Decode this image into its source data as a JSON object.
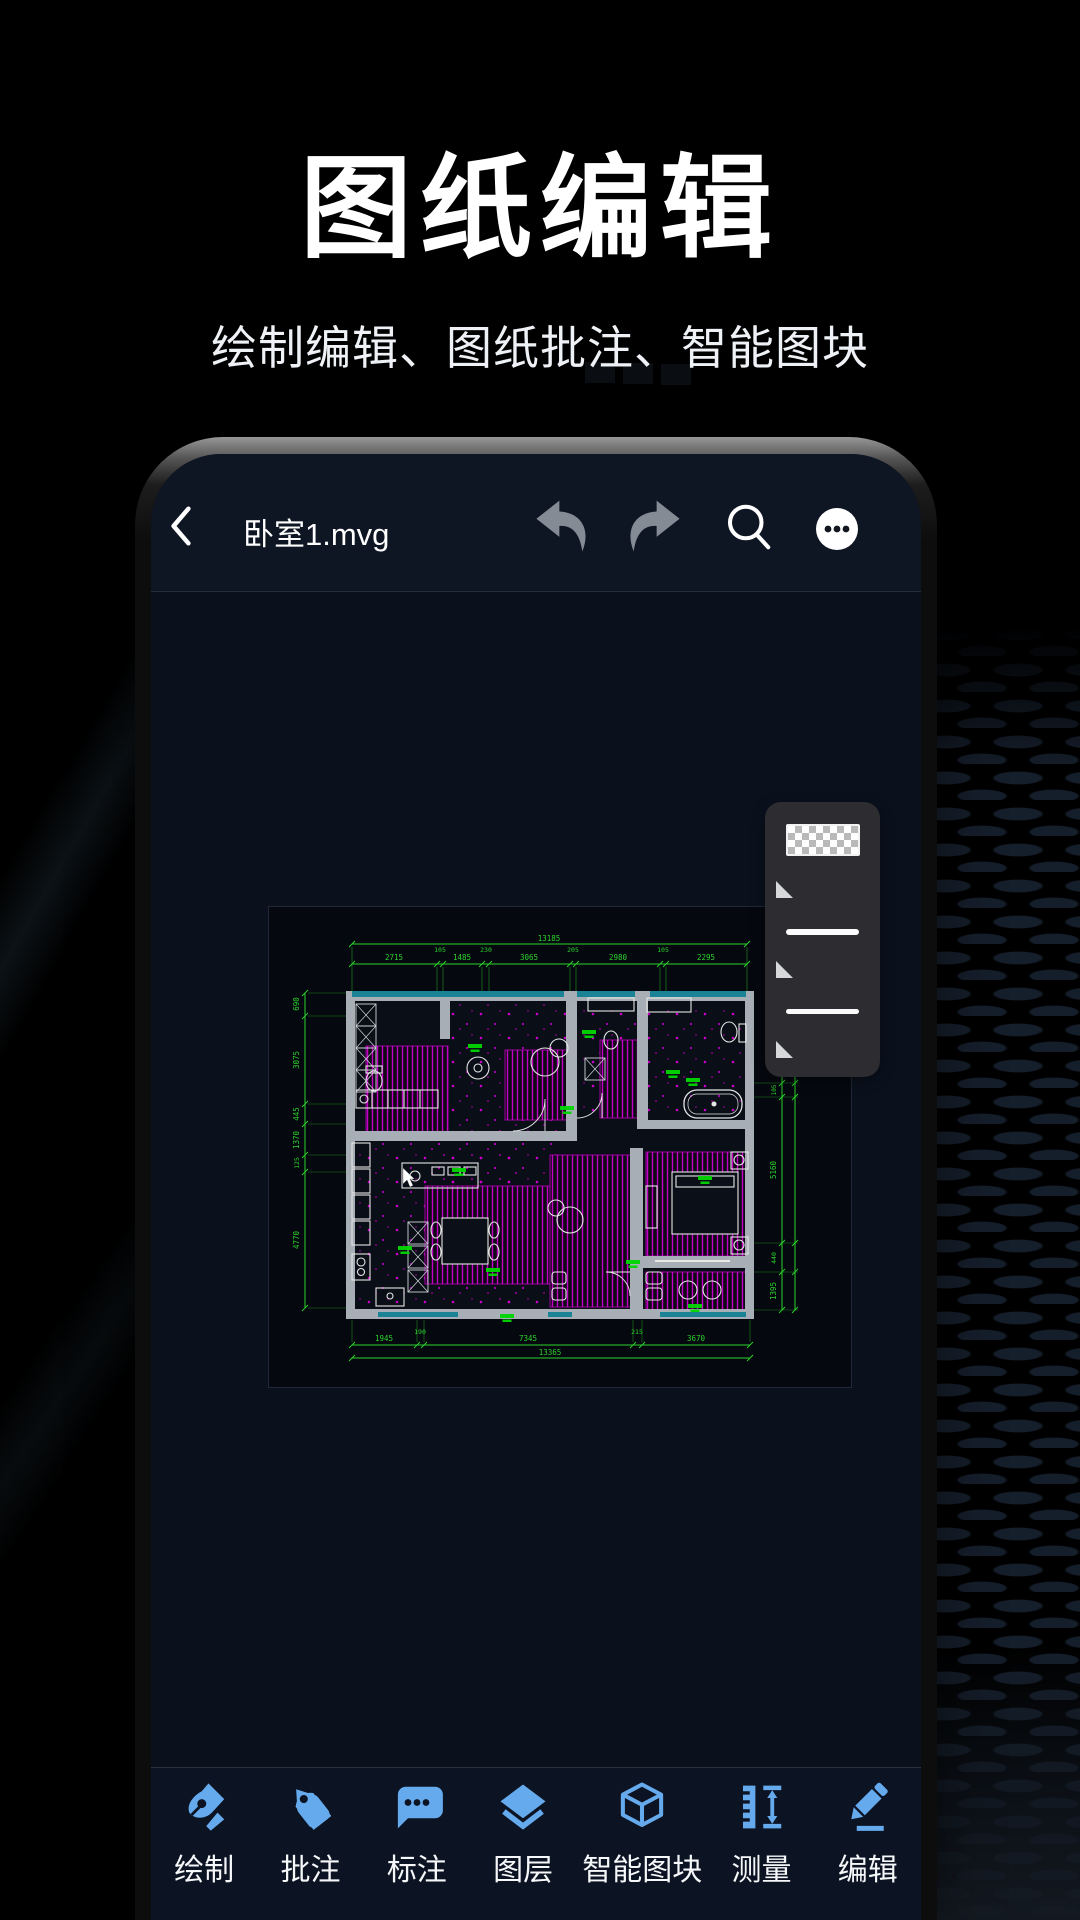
{
  "hero": {
    "title": "图纸编辑",
    "subtitle": "绘制编辑、图纸批注、智能图块"
  },
  "phone": {
    "top_bar": {
      "filename": "卧室1.mvg",
      "icons": [
        "back-chevron",
        "undo-arrow",
        "redo-arrow",
        "search-magnifier",
        "more-ellipsis"
      ]
    },
    "style_panel": {
      "swatch": "transparency-checker",
      "line_option_count": 2,
      "handle_count": 3
    },
    "canvas": {
      "dims": {
        "top_overall": "13185",
        "top_segments": [
          "2715",
          "105",
          "1485",
          "230",
          "3065",
          "205",
          "2980",
          "105",
          "2295"
        ],
        "left": [
          "690",
          "3075",
          "445",
          "1370",
          "125",
          "4770"
        ],
        "right": [
          "105",
          "5160",
          "440",
          "1395"
        ],
        "bottom_segments": [
          "1945",
          "190",
          "7345",
          "215",
          "3670"
        ],
        "bottom_overall": "13365"
      },
      "colors": {
        "dimension_green": "#2bd32b",
        "hatch_magenta": "#c400c4",
        "wall_gray": "#a8aeb6",
        "band_teal": "#1a8496",
        "fixture_white": "#e6e6e6",
        "label_green": "#00d800"
      }
    },
    "toolbar": {
      "icon_blue": "#66aaee",
      "items": [
        {
          "label": "绘制",
          "icon": "pen-nib"
        },
        {
          "label": "批注",
          "icon": "tag"
        },
        {
          "label": "标注",
          "icon": "comment-bubble"
        },
        {
          "label": "图层",
          "icon": "layers"
        },
        {
          "label": "智能图块",
          "icon": "cube-3d"
        },
        {
          "label": "测量",
          "icon": "measure-ruler"
        },
        {
          "label": "编辑",
          "icon": "pencil"
        }
      ]
    }
  }
}
